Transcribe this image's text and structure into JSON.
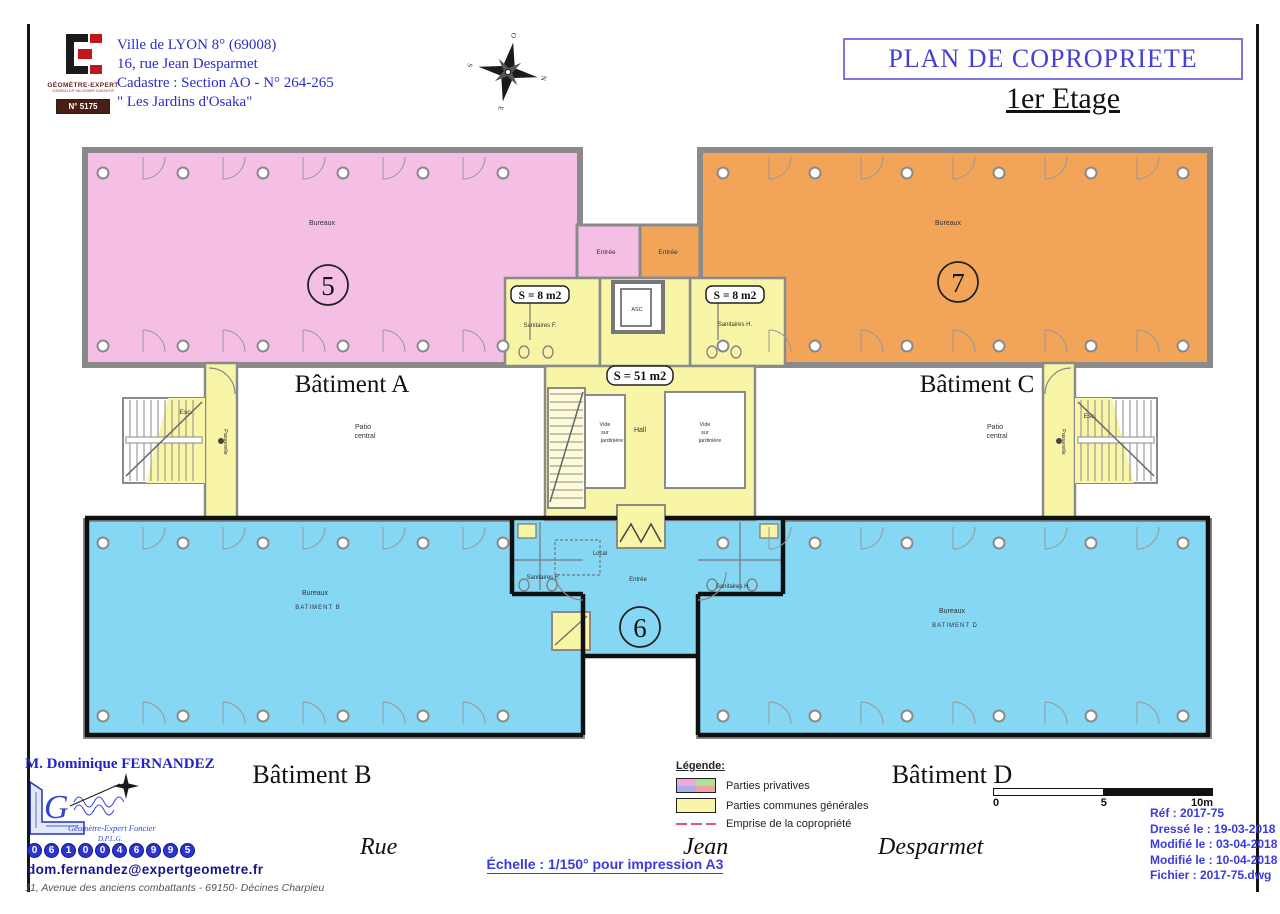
{
  "colors": {
    "privative_pink": "#F5BEE5",
    "privative_orange": "#F2A558",
    "privative_blue": "#85D7F3",
    "common_yellow": "#F8F5A6",
    "wall_gray": "#8A8A8A",
    "accent_blue": "#3A3AE0",
    "emprise_red": "#D85878",
    "legend_green": "#ACE59A",
    "legend_periwinkle": "#A8AEE8",
    "legend_salmon": "#EFA3A3"
  },
  "header": {
    "logo_brand": "GÉOMÈTRE-EXPERT",
    "logo_tagline": "CONSEILLER VALORISER GARANTIR",
    "logo_badge": "N° 5175",
    "address_lines": [
      "Ville de LYON 8° (69008)",
      "16, rue Jean Desparmet",
      "Cadastre : Section AO - N° 264-265",
      "\" Les Jardins d'Osaka\""
    ],
    "title": "PLAN DE COPROPRIETE",
    "subtitle": "1er Etage",
    "compass": {
      "n": "N",
      "e": "E",
      "s": "S",
      "o": "O"
    }
  },
  "plan": {
    "batA": {
      "name": "Bâtiment A",
      "room": "Bureaux",
      "lot": "5"
    },
    "batB": {
      "name": "Bâtiment B",
      "room": "Bureaux",
      "sub": "BATIMENT B",
      "lot": "6"
    },
    "batC": {
      "name": "Bâtiment C",
      "room": "Bureaux",
      "lot": "7"
    },
    "batD": {
      "name": "Bâtiment D",
      "room": "Bureaux",
      "sub": "BATIMENT D"
    },
    "patio": [
      "Patio",
      "central"
    ],
    "entree": "Entrée",
    "s8": "S = 8 m2",
    "s51": "S = 51 m2",
    "sanitaires_f": "Sanitaires F.",
    "sanitaires_h": "Sanitaires H.",
    "asc": "ASC",
    "hall": "Hall",
    "vide": [
      "Vide",
      "sur",
      "jardinière"
    ],
    "local": "Local",
    "passerelle": "Passerelle",
    "esc": "Esc."
  },
  "legend": {
    "title": "Légende:",
    "privatives": "Parties privatives",
    "communes": "Parties communes générales",
    "emprise": "Emprise de la copropriété"
  },
  "scalebar": {
    "zero": "0",
    "five": "5",
    "ten": "10m"
  },
  "footer": {
    "surveyor": "M. Dominique FERNANDEZ",
    "logo_line1": "Géomètre-Expert Foncier",
    "logo_line2": "D.P.L.G.",
    "phone_digits": [
      "0",
      "6",
      "1",
      "0",
      "0",
      "4",
      "6",
      "9",
      "9",
      "5"
    ],
    "email": "dom.fernandez@expertgeometre.fr",
    "office": "11, Avenue des anciens combattants - 69150- Décines Charpieu",
    "street_rue": "Rue",
    "street_jean": "Jean",
    "street_desparmet": "Desparmet",
    "scale_note": "Échelle : 1/150° pour impression A3",
    "info_lines": [
      "Réf : 2017-75",
      "Dressé le : 19-03-2018",
      "Modifié le : 03-04-2018",
      "Modifié le : 10-04-2018",
      "Fichier : 2017-75.dwg"
    ]
  }
}
